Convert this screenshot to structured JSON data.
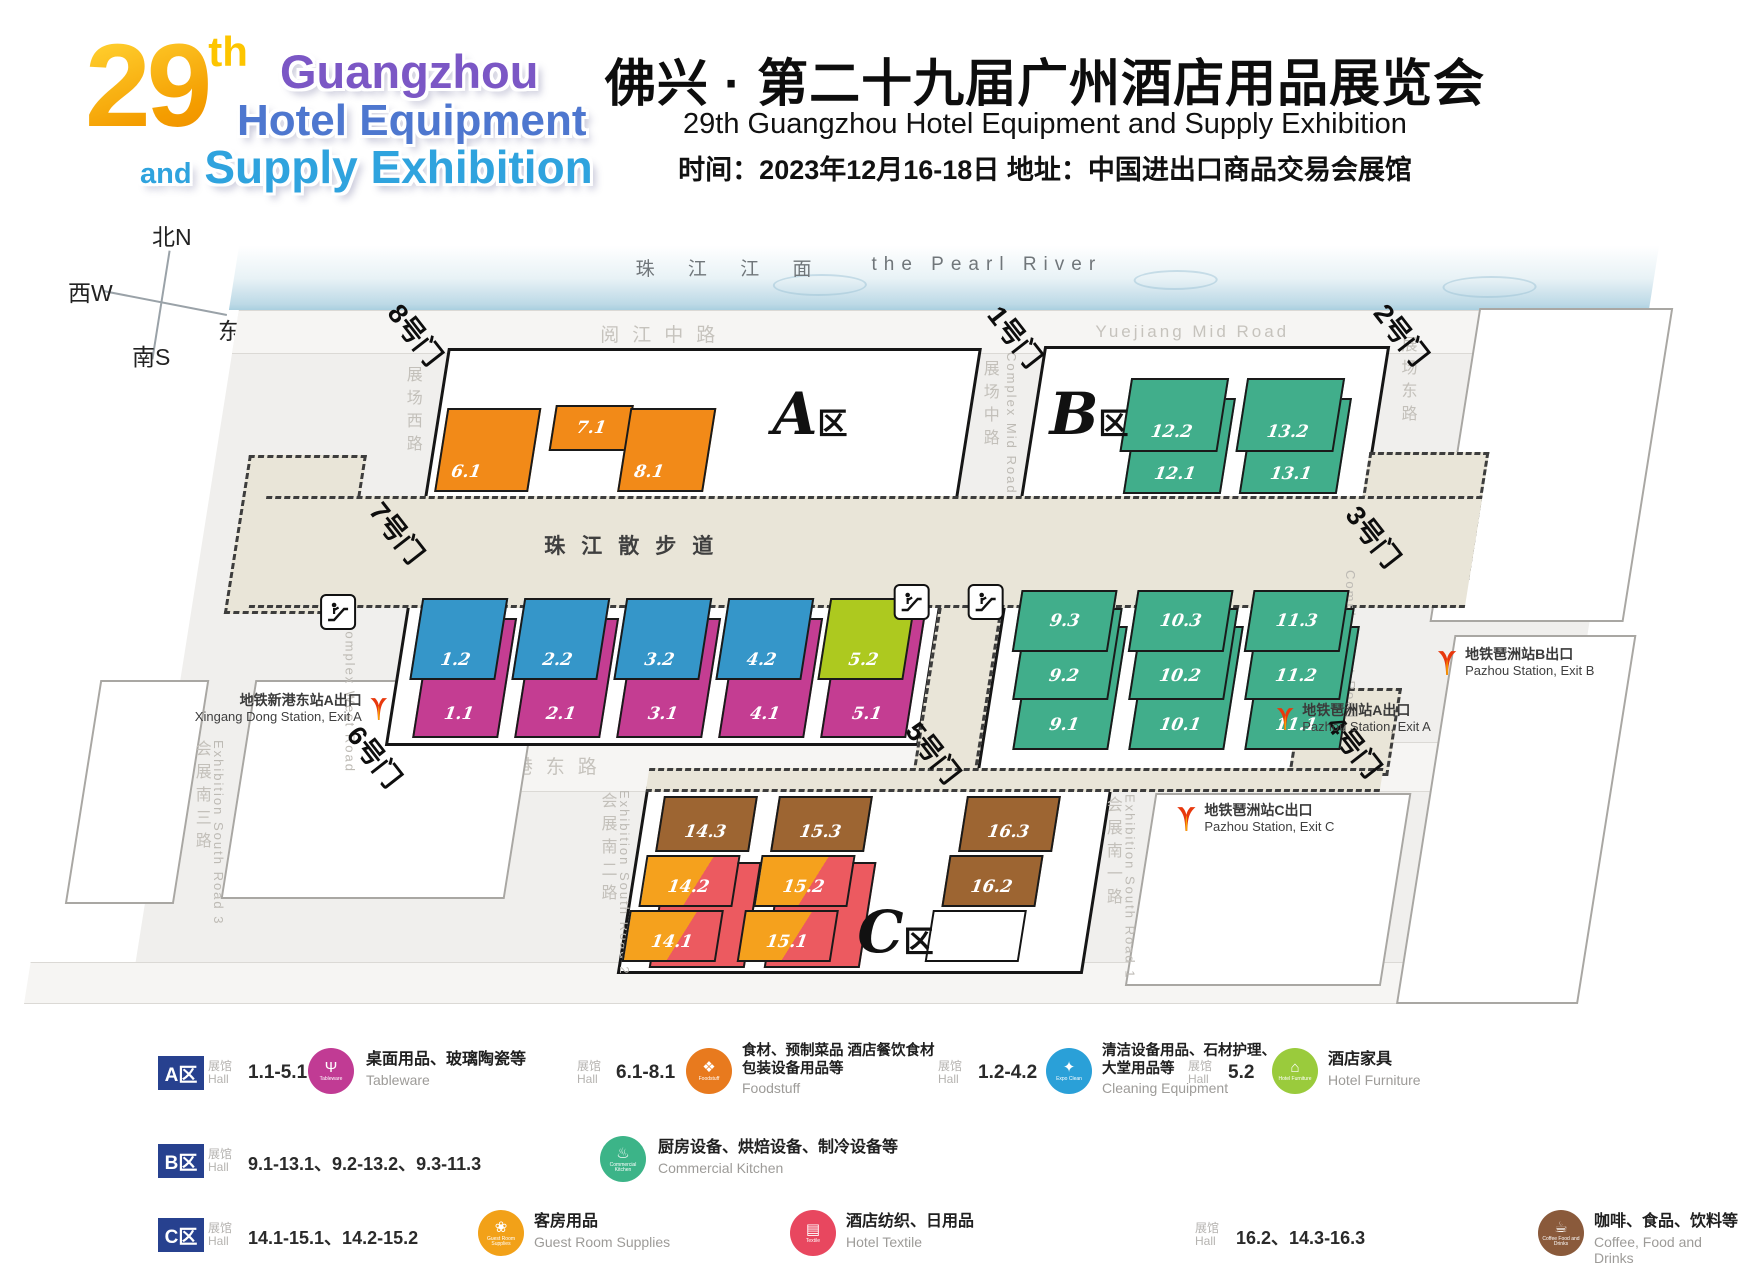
{
  "header": {
    "logo": {
      "num": "29",
      "sup": "th",
      "line1": "Guangzhou",
      "line2": "Hotel Equipment",
      "line3_and": "and",
      "line3": "Supply Exhibition"
    },
    "title_cn": "佛兴 · 第二十九届广州酒店用品展览会",
    "title_en": "29th Guangzhou Hotel Equipment and Supply Exhibition",
    "info": "时间：2023年12月16-18日  地址：中国进出口商品交易会展馆"
  },
  "compass": {
    "n": "北N",
    "w": "西W",
    "e": "东E",
    "s": "南S"
  },
  "map": {
    "river": {
      "cn": "珠 江 江 面",
      "en": "the Pearl River"
    },
    "walkway": "珠江散步道",
    "roads": {
      "yuejiang_cn": "阅江中路",
      "yuejiang_en": "Yuejiang Mid Road",
      "xingang": "新港东路",
      "west_cn": "展场西路",
      "west_en": "Complex West Road",
      "mid_cn": "展场中路",
      "mid_en": "Complex Mid Road",
      "east_cn": "展场东路",
      "east_en": "Complex East Road",
      "s1_cn": "会展南一路",
      "s1_en": "Exhibition South Road 1",
      "s2_cn": "会展南二路",
      "s2_en": "Exhibition South Road 2",
      "s3_cn": "会展南三路",
      "s3_en": "Exhibition South Road 3"
    },
    "gates": {
      "g1": "1号门",
      "g2": "2号门",
      "g3": "3号门",
      "g4": "4号门",
      "g5": "5号门",
      "g6": "6号门",
      "g7": "7号门",
      "g8": "8号门"
    },
    "areas": {
      "a": "A",
      "b": "B",
      "c": "C",
      "suffix": "区"
    },
    "halls": {
      "h6_1": "6.1",
      "h7_1": "7.1",
      "h8_1": "8.1",
      "h1_2": "1.2",
      "h2_2": "2.2",
      "h3_2": "3.2",
      "h4_2": "4.2",
      "h5_2": "5.2",
      "h1_1": "1.1",
      "h2_1": "2.1",
      "h3_1": "3.1",
      "h4_1": "4.1",
      "h5_1": "5.1",
      "h12_2": "12.2",
      "h13_2": "13.2",
      "h12_1": "12.1",
      "h13_1": "13.1",
      "h9_3": "9.3",
      "h10_3": "10.3",
      "h11_3": "11.3",
      "h9_2": "9.2",
      "h10_2": "10.2",
      "h11_2": "11.2",
      "h9_1": "9.1",
      "h10_1": "10.1",
      "h11_1": "11.1",
      "h14_3": "14.3",
      "h15_3": "15.3",
      "h16_3": "16.3",
      "h14_2": "14.2",
      "h15_2": "15.2",
      "h16_2": "16.2",
      "h14_1": "14.1",
      "h15_1": "15.1"
    },
    "stations": {
      "xingang": {
        "cn": "地铁新港东站A出口",
        "en": "Xingang Dong Station, Exit A"
      },
      "pazhou_b": {
        "cn": "地铁琶洲站B出口",
        "en": "Pazhou Station, Exit B"
      },
      "pazhou_a": {
        "cn": "地铁琶洲站A出口",
        "en": "Pazhou Station, Exit A"
      },
      "pazhou_c": {
        "cn": "地铁琶洲站C出口",
        "en": "Pazhou Station, Exit C"
      }
    }
  },
  "legend": {
    "hall_cn": "展馆",
    "hall_en": "Hall",
    "badges": {
      "a": "A区",
      "b": "B区",
      "c": "C区"
    },
    "groups": {
      "tableware": {
        "range": "1.1-5.1",
        "cn": "桌面用品、玻璃陶瓷等",
        "en": "Tableware",
        "icon_label": "Tableware",
        "color": "#c13b94"
      },
      "foodstuff": {
        "range": "6.1-8.1",
        "cn": "食材、预制菜品 酒店餐饮食材\n包装设备用品等",
        "en": "Foodstuff",
        "icon_label": "Foodstuff",
        "color": "#e87a1e"
      },
      "clean": {
        "range": "1.2-4.2",
        "cn": "清洁设备用品、石材护理、\n大堂用品等",
        "en": "Cleaning Equipment",
        "icon_label": "Expo Clean",
        "color": "#2aa0d8"
      },
      "furniture": {
        "range": "5.2",
        "cn": "酒店家具",
        "en": "Hotel Furniture",
        "icon_label": "Hotel Furniture",
        "color": "#9acb3c"
      },
      "kitchen": {
        "range": "9.1-13.1、9.2-13.2、9.3-11.3",
        "cn": "厨房设备、烘焙设备、制冷设备等",
        "en": "Commercial Kitchen",
        "icon_label": "Commercial Kitchen",
        "color": "#3cb488"
      },
      "guest": {
        "range": "14.1-15.1、14.2-15.2",
        "cn": "客房用品",
        "en": "Guest Room Supplies",
        "icon_label": "Guest Room Supplies",
        "color": "#f2a118"
      },
      "textile": {
        "cn": "酒店纺织、日用品",
        "en": "Hotel Textile",
        "icon_label": "Textile",
        "color": "#e8475f"
      },
      "coffee": {
        "range": "16.2、14.3-16.3",
        "cn": "咖啡、食品、饮料等",
        "en": "Coffee, Food and Drinks",
        "icon_label": "Coffee Food and Drinks",
        "color": "#8a5a3b"
      }
    }
  }
}
